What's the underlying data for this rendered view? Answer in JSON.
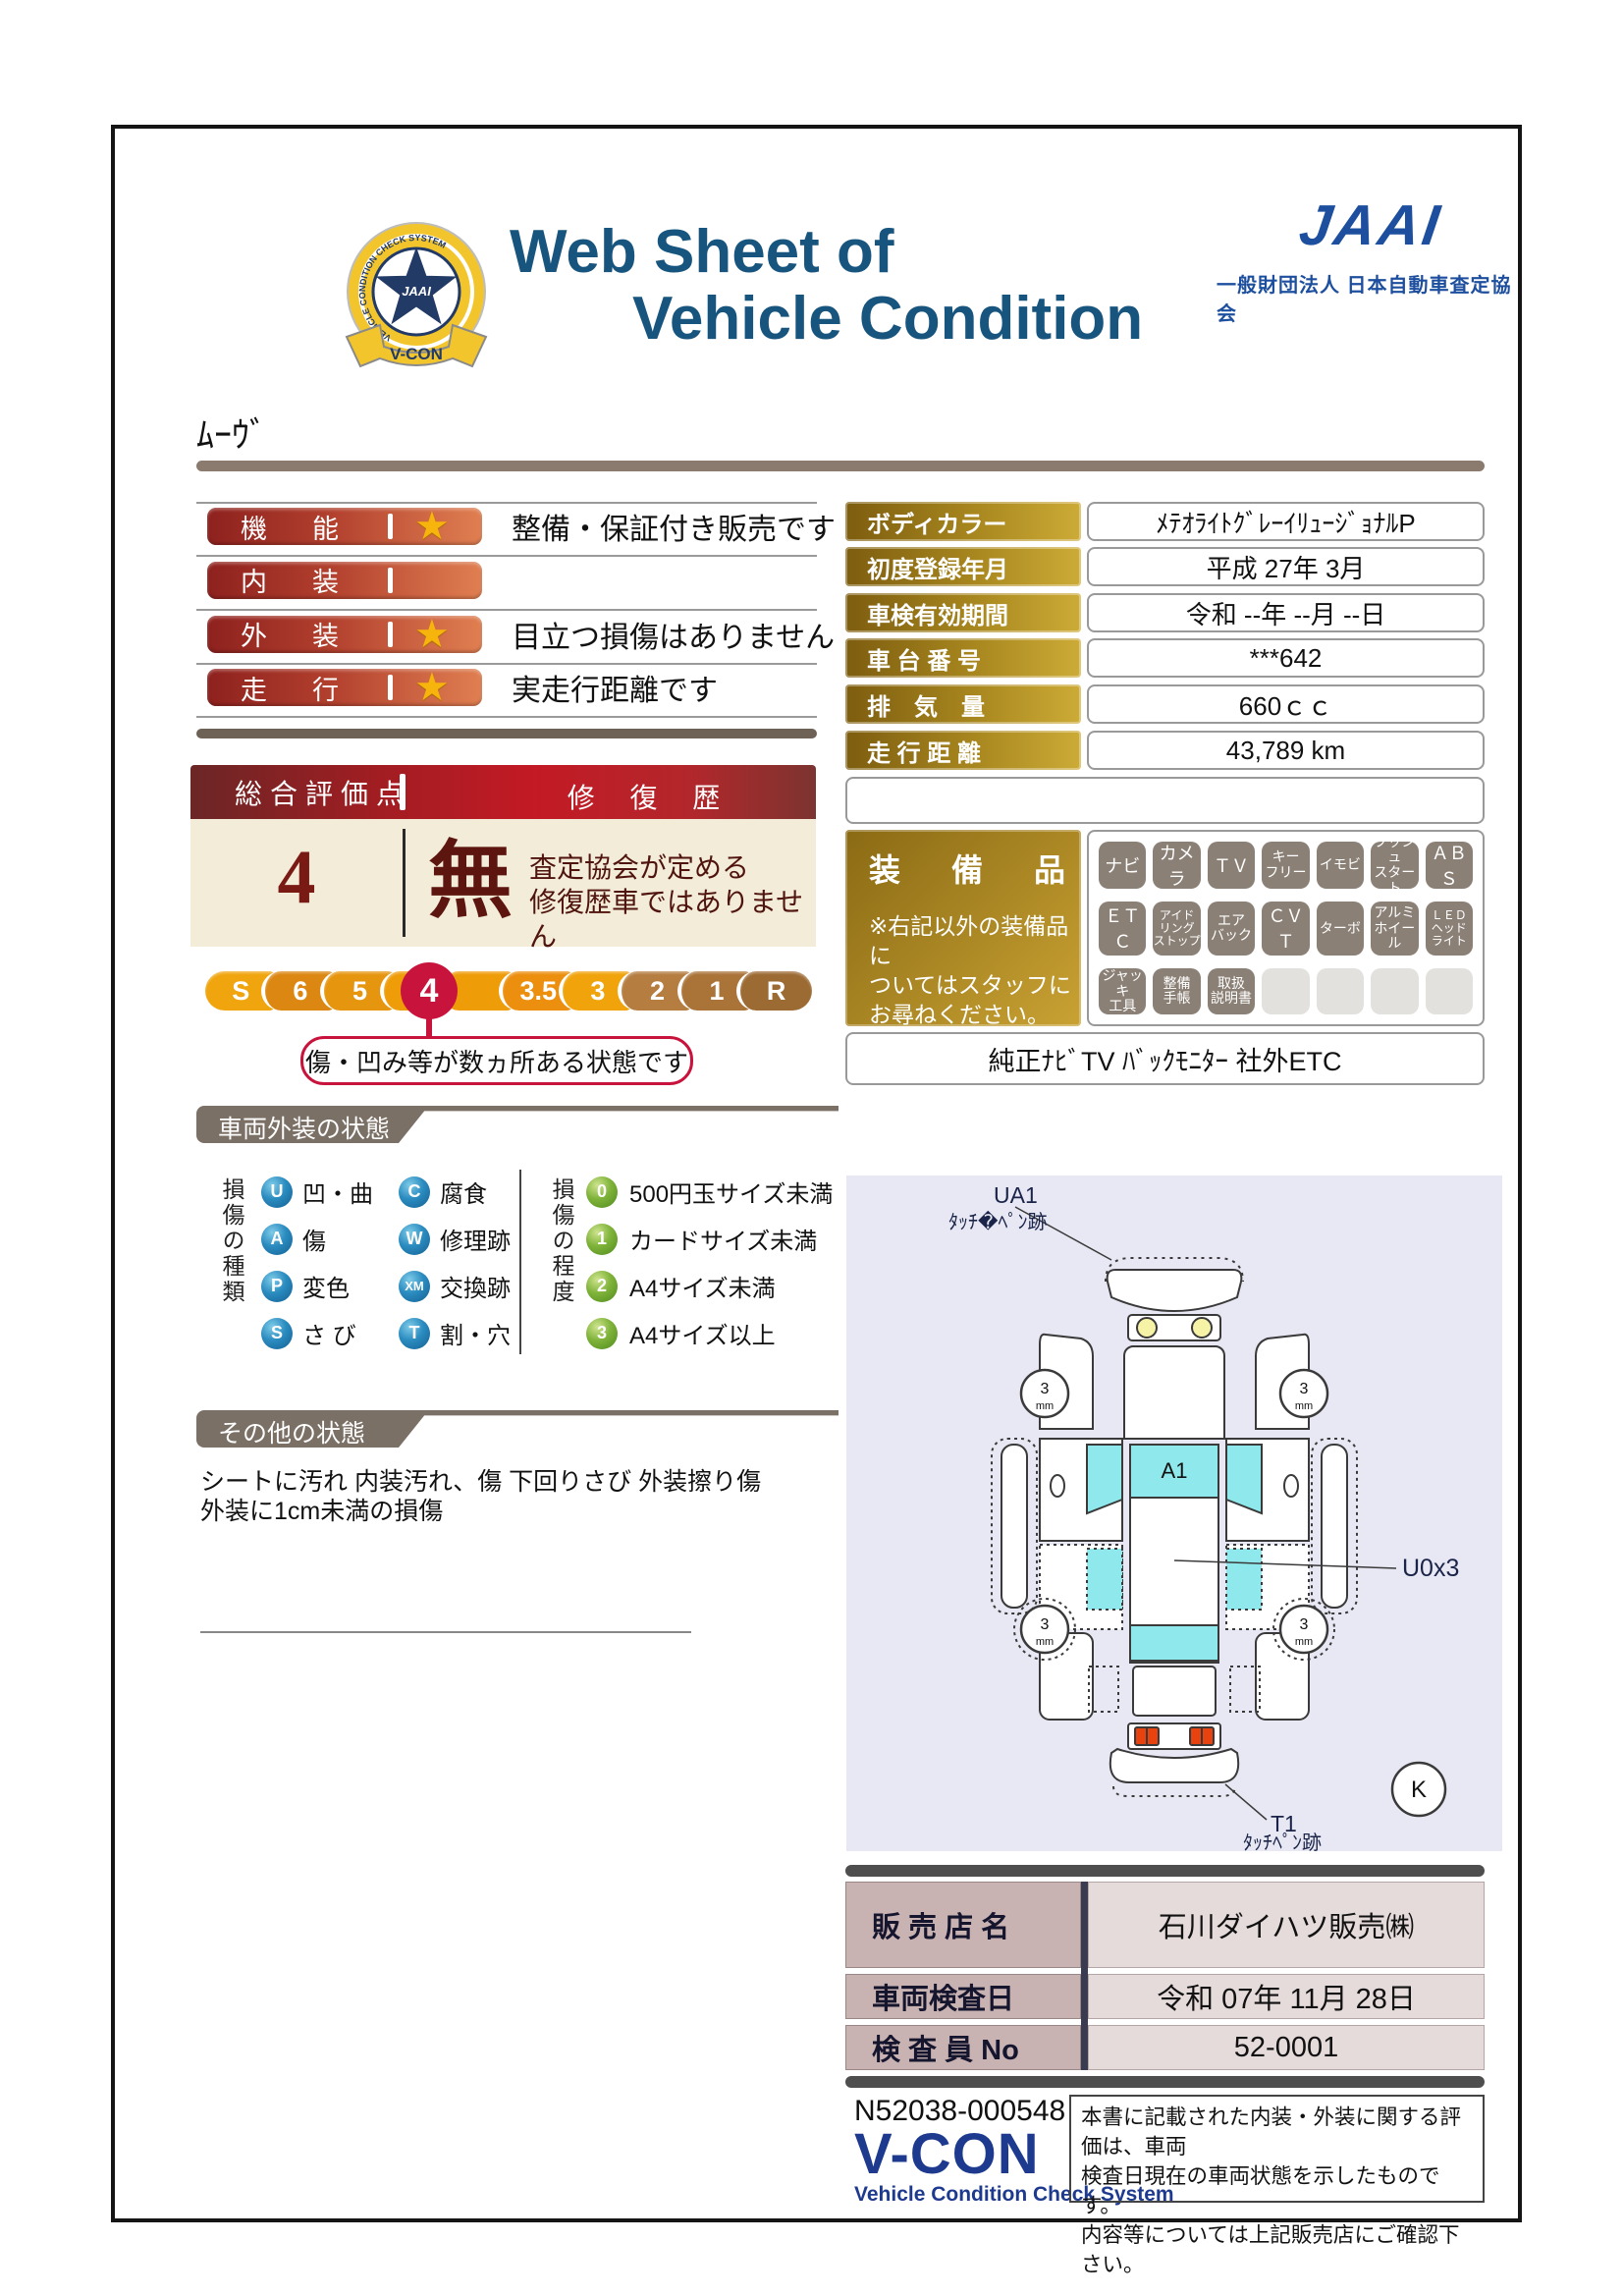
{
  "header": {
    "title_line1": "Web Sheet of",
    "title_line2": "Vehicle Condition",
    "jaai_logo": "JAAI",
    "jaai_org": "一般財団法人 日本自動車査定協会",
    "badge": {
      "star_text": "JAAI",
      "ring_text": "VEHICLE CONDITION CHECK SYSTEM",
      "ribbon_text": "V-CON"
    }
  },
  "vehicle_name": "ﾑｰｳﾞ",
  "ratings": {
    "rows": [
      {
        "label": "機能",
        "star": true,
        "comment": "整備・保証付き販売です"
      },
      {
        "label": "内装",
        "star": false,
        "comment": ""
      },
      {
        "label": "外装",
        "star": true,
        "comment": "目立つ損傷はありません"
      },
      {
        "label": "走行",
        "star": true,
        "comment": "実走行距離です"
      }
    ]
  },
  "overall": {
    "score_label": "総合評価点",
    "score": "4",
    "repair_label": "修 復 歴",
    "repair_value": "無",
    "repair_note": "査定協会が定める\n修復歴車ではありません"
  },
  "scale": {
    "labels": [
      "S",
      "6",
      "5",
      "4.5",
      "4",
      "3.5",
      "3",
      "2",
      "1",
      "R"
    ],
    "selected": "4",
    "callout": "傷・凹み等が数ヵ所ある状態です"
  },
  "info": {
    "rows": [
      {
        "label": "ボディカラー",
        "value": "ﾒﾃｵﾗｲﾄｸﾞﾚｰｲﾘｭｰｼﾞｮﾅﾙP"
      },
      {
        "label": "初度登録年月",
        "value": "平成 27年 3月"
      },
      {
        "label": "車検有効期間",
        "value": "令和 --年 --月 --日"
      },
      {
        "label": "車 台 番 号",
        "value": "***642"
      },
      {
        "label": "排　気　量",
        "value": "660ｃｃ"
      },
      {
        "label": "走 行 距 離",
        "value": "43,789 km"
      }
    ]
  },
  "equipment": {
    "label": "装　備　品",
    "note": "※右記以外の装備品に\nついてはスタッフに\nお尋ねください。",
    "badges_row1": [
      "ナビ",
      "カメラ",
      "ＴＶ",
      "キー\nフリー",
      "イモビ",
      "プッシュ\nスタート",
      "ＡＢＳ"
    ],
    "badges_row2": [
      "ＥＴＣ",
      "アイド\nリング\nストップ",
      "エア\nバック",
      "ＣＶＴ",
      "ターボ",
      "アルミ\nホイール",
      "ＬＥＤ\nヘッド\nライト"
    ],
    "badges_row3": [
      "ジャッキ\n工具",
      "整備\n手帳",
      "取扱\n説明書",
      "",
      "",
      "",
      ""
    ],
    "footer": "純正ﾅﾋﾞTV ﾊﾞｯｸﾓﾆﾀｰ 社外ETC"
  },
  "exterior": {
    "section_title": "車両外装の状態",
    "type_label": "損傷の種類",
    "types": [
      {
        "code": "U",
        "name": "凹・曲"
      },
      {
        "code": "C",
        "name": "腐食"
      },
      {
        "code": "A",
        "name": "傷"
      },
      {
        "code": "W",
        "name": "修理跡"
      },
      {
        "code": "P",
        "name": "変色"
      },
      {
        "code": "XM",
        "name": "交換跡"
      },
      {
        "code": "S",
        "name": "さ び"
      },
      {
        "code": "T",
        "name": "割・穴"
      }
    ],
    "degree_label": "損傷の程度",
    "degrees": [
      {
        "code": "0",
        "name": "500円玉サイズ未満"
      },
      {
        "code": "1",
        "name": "カードサイズ未満"
      },
      {
        "code": "2",
        "name": "A4サイズ未満"
      },
      {
        "code": "3",
        "name": "A4サイズ以上"
      }
    ]
  },
  "other": {
    "section_title": "その他の状態",
    "line1": "シートに汚れ 内装汚れ、傷 下回りさび 外装擦り傷",
    "line2": "外装に1cm未満の損傷"
  },
  "diagram": {
    "ua1": "UA1",
    "ua1_note": "ﾀｯﾁ�ﾍﾟﾝ跡",
    "a1": "A1",
    "u0": "U0x3",
    "t1": "T1",
    "t1_note": "ﾀｯﾁﾍﾟﾝ跡",
    "k": "K",
    "wheel_value": "3",
    "wheel_unit": "mm"
  },
  "dealer": {
    "rows": [
      {
        "label": "販 売 店 名",
        "value": "石川ダイハツ販売㈱"
      },
      {
        "label": "車両検査日",
        "value": "令和 07年 11月 28日"
      },
      {
        "label": "検 査 員 No",
        "value": "52-0001"
      }
    ]
  },
  "footer": {
    "doc_no": "N52038-000548",
    "vcon": "V-CON",
    "vcon_sub": "Vehicle Condition Check System",
    "disclaimer": "本書に記載された内装・外装に関する評価は、車両\n検査日現在の車両状態を示したものです。\n内容等については上記販売店にご確認下さい。"
  },
  "colors": {
    "title_blue": "#17557f",
    "jaai_blue": "#1d4f9e",
    "rating_bar_red": "#8e211e",
    "score_cream": "#f3ecd9",
    "gold": "#a8871f",
    "scale_red": "#c8143c",
    "badge_gray": "#8b8076",
    "section_gray": "#7b7066",
    "diagram_bg": "#e8e8f4",
    "dealer_label_pink": "#c8b2b2",
    "vcon_blue": "#1e3a8e"
  }
}
